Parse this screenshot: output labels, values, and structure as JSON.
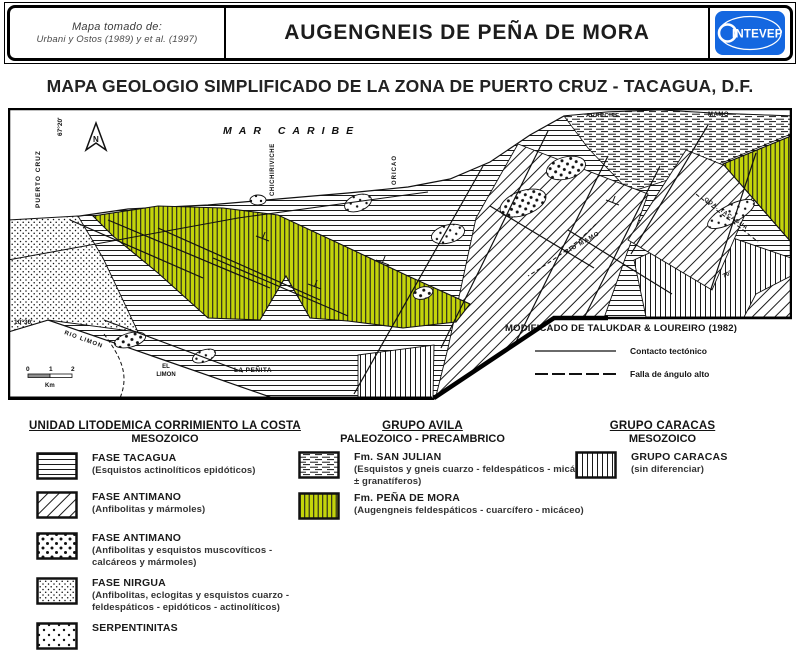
{
  "header": {
    "source": {
      "line1": "Mapa tomado de:",
      "line2": "Urbani y Ostos (1989) y et al. (1997)"
    },
    "title": "AUGENGNEIS DE PEÑA DE MORA",
    "logo_text": "INTEVEP",
    "logo_color": "#1467e0"
  },
  "subtitle": "MAPA GEOLOGIO SIMPLIFICADO DE LA ZONA DE PUERTO CRUZ - TACAGUA, D.F.",
  "map": {
    "labels": {
      "mar_caribe": "MAR CARIBE",
      "north": "N",
      "coord_top": "67°20'",
      "coord_left": "10°30'",
      "puerto_cruz": "PUERTO CRUZ",
      "chichiriviche": "CHICHIRIVICHE",
      "oricao": "ORICAO",
      "arrecife": "ARRECIFE",
      "mamo": "MAMO",
      "rio_mamo": "RIO MAMO",
      "qda_tacagua": "QDA. TACAGUA",
      "rio_limon": "RIO LIMON",
      "el_limon_l1": "EL",
      "el_limon_l2": "LIMON",
      "la_penita": "LA PEÑITA",
      "dip": "70°"
    },
    "scale": {
      "zero": "0",
      "one": "1",
      "two": "2",
      "unit": "Km"
    },
    "attribution": "MODIFICADO DE TALUKDAR & LOUREIRO (1982)",
    "line_legend": [
      {
        "label": "Contacto tectónico"
      },
      {
        "label": "Falla de ángulo alto"
      }
    ],
    "colors": {
      "pena_de_mora_green": "#c3d40a"
    }
  },
  "legend": {
    "col1": {
      "header1": "UNIDAD LITODEMICA CORRIMIENTO LA COSTA",
      "header2": "MESOZOICO",
      "items": [
        {
          "name": "FASE TACAGUA",
          "desc": "(Esquistos actinolíticos epidóticos)",
          "pattern": "horizontal-lines"
        },
        {
          "name": "FASE ANTIMANO",
          "desc": "(Anfibolitas y mármoles)",
          "pattern": "diagonal-lines"
        },
        {
          "name": "FASE ANTIMANO",
          "desc": "(Anfibolitas y esquistos muscovíticos - calcáreos y mármoles)",
          "pattern": "coarse-dots"
        },
        {
          "name": "FASE NIRGUA",
          "desc": "(Anfibolitas, eclogitas y esquistos cuarzo - feldespáticos - epidóticos - actinolíticos)",
          "pattern": "fine-dots"
        },
        {
          "name": "SERPENTINITAS",
          "desc": "",
          "pattern": "dots"
        }
      ]
    },
    "col2": {
      "header1": "GRUPO AVILA",
      "header2": "PALEOZOICO - PRECAMBRICO",
      "items": [
        {
          "name": "Fm. SAN JULIAN",
          "desc": "(Esquistos y gneis cuarzo - feldespáticos - micáceos ± granatíferos)",
          "pattern": "dashed-lines"
        },
        {
          "name": "Fm. PEÑA DE MORA",
          "desc": "(Augengneis feldespáticos - cuarcífero - micáceo)",
          "pattern": "green-vertical-lines"
        }
      ]
    },
    "col3": {
      "header1": "GRUPO CARACAS",
      "header2": "MESOZOICO",
      "items": [
        {
          "name": "GRUPO CARACAS",
          "desc": "(sin diferenciar)",
          "pattern": "vertical-lines"
        }
      ]
    }
  }
}
